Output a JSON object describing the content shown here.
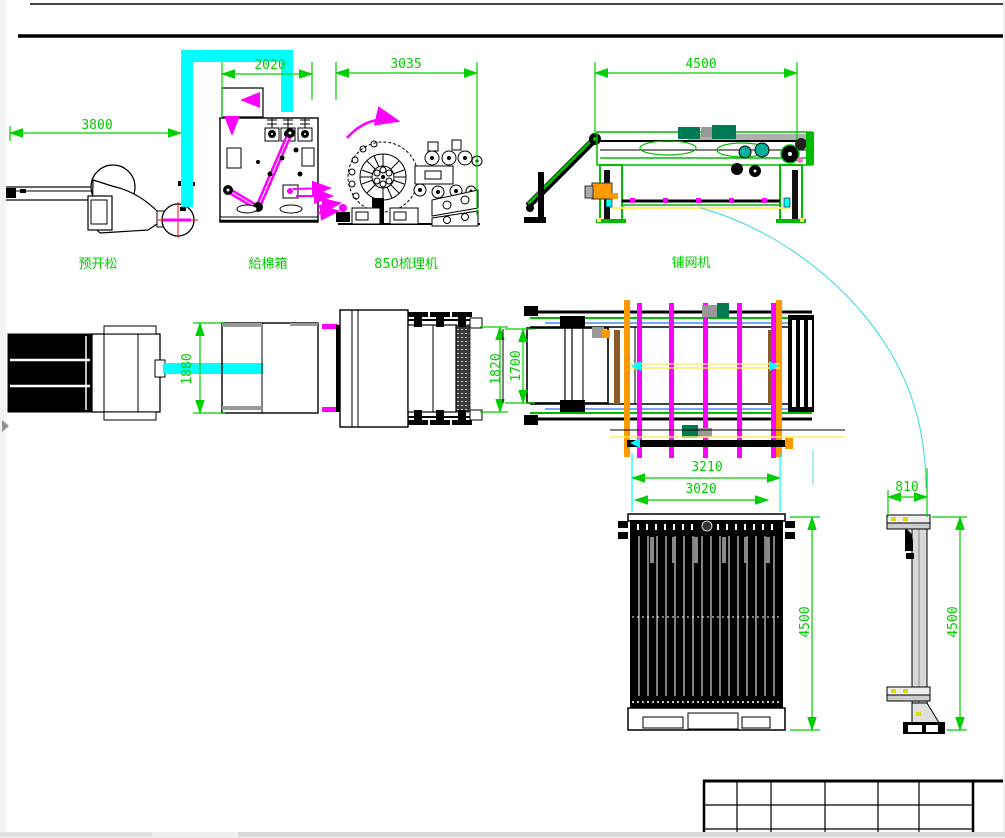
{
  "drawing": {
    "machines": [
      {
        "id": "pre-opener",
        "label": "预开松"
      },
      {
        "id": "feed-box",
        "label": "給棉箱"
      },
      {
        "id": "carding-machine",
        "label": "850梳理机"
      },
      {
        "id": "lapper",
        "label": "铺网机"
      }
    ],
    "dimensions": [
      {
        "id": "pre-opener-length",
        "value": "3800"
      },
      {
        "id": "feed-box-width",
        "value": "2020"
      },
      {
        "id": "carding-length",
        "value": "3035"
      },
      {
        "id": "lapper-length",
        "value": "4500"
      },
      {
        "id": "pre-opener-depth",
        "value": "1880"
      },
      {
        "id": "carding-depth",
        "value": "1820"
      },
      {
        "id": "lapper-depth",
        "value": "1700"
      },
      {
        "id": "lapper-span-outer",
        "value": "3210"
      },
      {
        "id": "lapper-span-inner",
        "value": "3020"
      },
      {
        "id": "curtain-height-front",
        "value": "4500"
      },
      {
        "id": "curtain-depth",
        "value": "810"
      },
      {
        "id": "curtain-height-side",
        "value": "4500"
      }
    ],
    "colors": {
      "dimension_green": "#00cf00",
      "duct_cyan": "#00ffff",
      "conveyor_magenta": "#ff00ff",
      "outline_black": "#000000",
      "crosshair_red": "#ff0000",
      "lapper_green": "#00bb00",
      "accent_orange": "#ff9900",
      "accent_yellow": "#ffee66",
      "accent_teal": "#007a55",
      "accent_blue": "#4488ff",
      "leader_cyan": "#55dce8"
    },
    "title_block": {
      "columns": 6,
      "rows": 3,
      "content": "empty"
    }
  },
  "window": {
    "h_scrollbar": true,
    "panel_toggle": "right-arrow"
  }
}
